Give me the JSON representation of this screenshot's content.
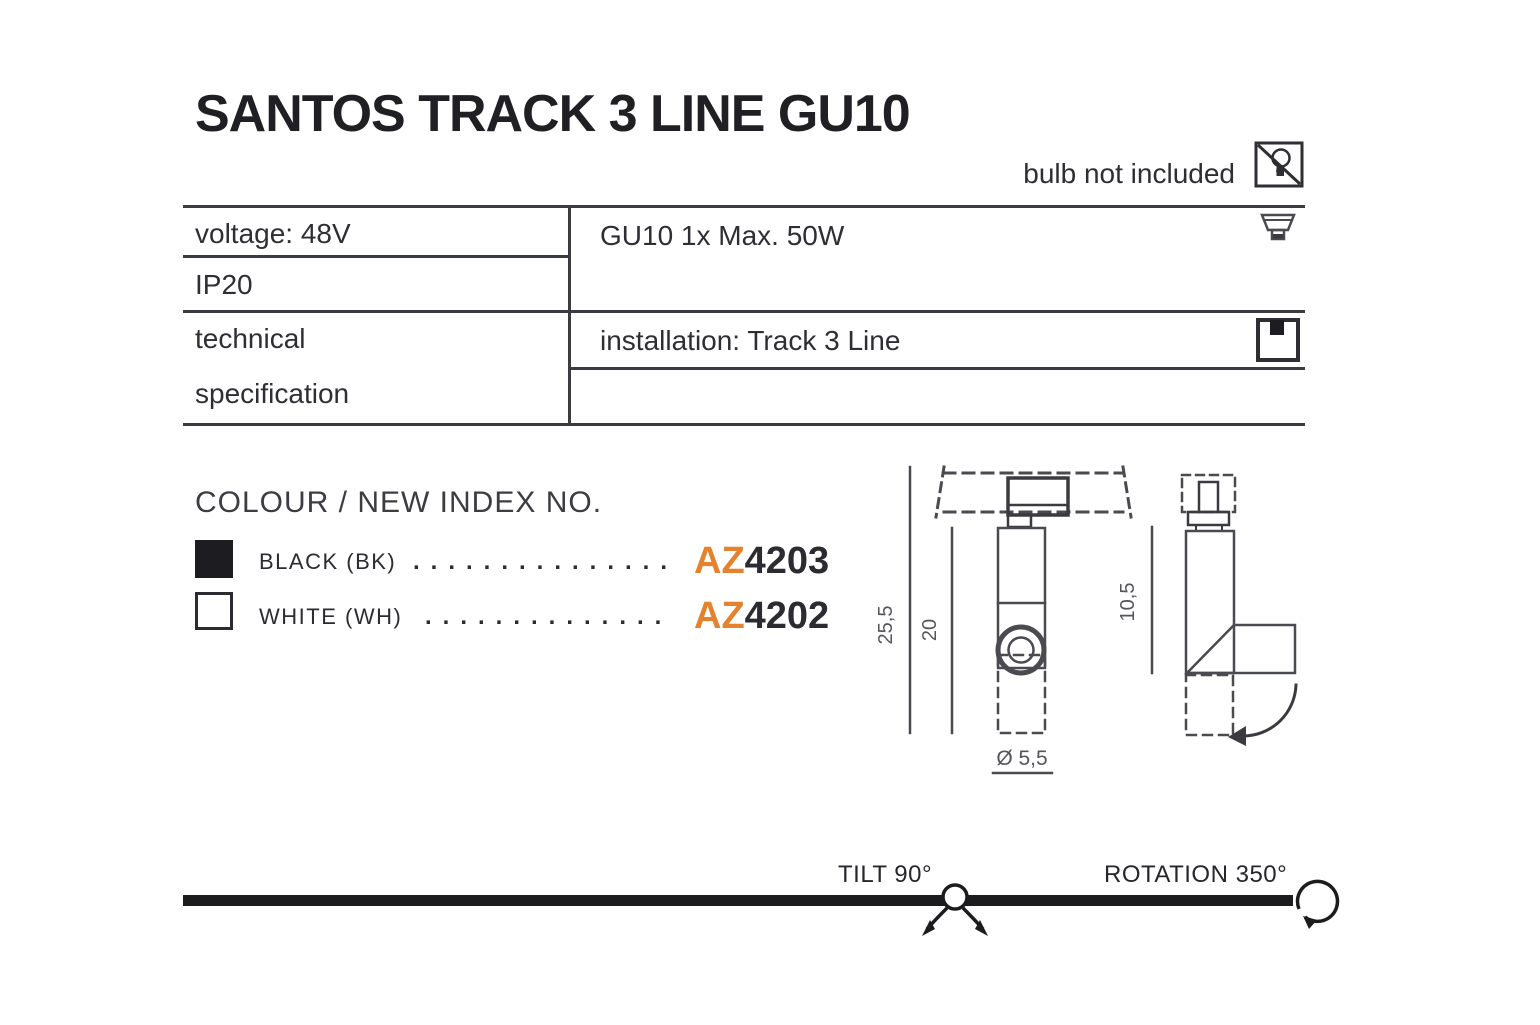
{
  "product": {
    "title": "SANTOS TRACK 3 LINE GU10",
    "bulb_note": "bulb not included"
  },
  "spec_table": {
    "voltage": "voltage: 48V",
    "ip_rating": "IP20",
    "left_header_line1": "technical",
    "left_header_line2": "specification",
    "lamp": "GU10 1x Max. 50W",
    "installation": "installation: Track 3 Line"
  },
  "colour_section": {
    "heading": "COLOUR / NEW INDEX NO.",
    "options": [
      {
        "colour": "black",
        "label": "BLACK (BK)",
        "dots": "...............",
        "code_prefix": "AZ",
        "code_number": "4203"
      },
      {
        "colour": "white",
        "label": "WHITE (WH)",
        "dots": "..............",
        "code_prefix": "AZ",
        "code_number": "4202"
      }
    ]
  },
  "dimensions": {
    "overall_height": "25,5",
    "body_height": "20",
    "side_height": "10,5",
    "diameter": "Ø 5,5"
  },
  "motion": {
    "tilt": "TILT 90°",
    "rotation": "ROTATION 350°"
  },
  "colors": {
    "ink": "#2d2d33",
    "table_line": "#3b3b41",
    "drawing_line": "#4a4a50",
    "accent_orange": "#E5822D"
  }
}
